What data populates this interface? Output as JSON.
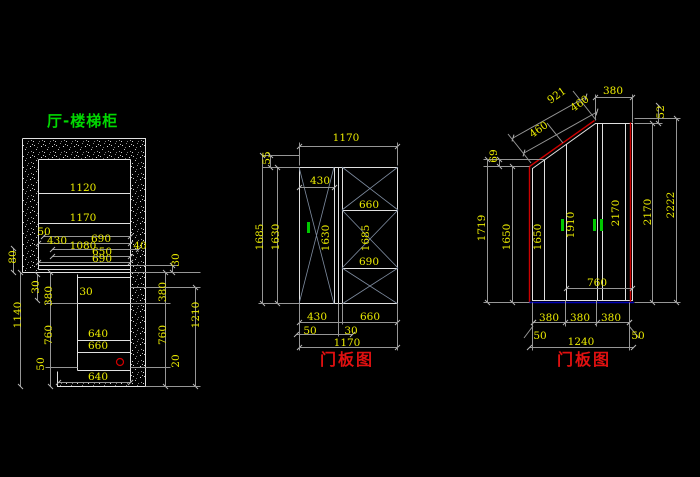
{
  "drawing_title": "厅-楼梯柜",
  "palette": {
    "background": "#000000",
    "outline_white": "#e0e0e0",
    "dim_line_gray": "#969696",
    "dim_text_yellow": "#ebeb00",
    "title_green": "#00d900",
    "caption_red": "#e01010",
    "edge_red": "#cc0000",
    "handle_green": "#00c800",
    "base_blue": "#0000b4",
    "swing_line_blue_gray": "#7e8ca0"
  },
  "views": {
    "section": {
      "title": "厅-楼梯柜",
      "labels": [
        {
          "text": "1120",
          "x": 83,
          "y": 188
        },
        {
          "text": "1170",
          "x": 83,
          "y": 218
        },
        {
          "text": "50",
          "x": 44,
          "y": 232
        },
        {
          "text": "430",
          "x": 57,
          "y": 241
        },
        {
          "text": "690",
          "x": 101,
          "y": 239
        },
        {
          "text": "1080",
          "x": 83,
          "y": 246
        },
        {
          "text": "40",
          "x": 140,
          "y": 246
        },
        {
          "text": "650",
          "x": 102,
          "y": 252
        },
        {
          "text": "690",
          "x": 102,
          "y": 259
        },
        {
          "text": "80",
          "x": 13,
          "y": 257,
          "rot": -90
        },
        {
          "text": "30",
          "x": 36,
          "y": 287,
          "rot": -90
        },
        {
          "text": "380",
          "x": 49,
          "y": 296,
          "rot": -90
        },
        {
          "text": "1140",
          "x": 18,
          "y": 315,
          "rot": -90
        },
        {
          "text": "760",
          "x": 49,
          "y": 335,
          "rot": -90
        },
        {
          "text": "50",
          "x": 41,
          "y": 364,
          "rot": -90
        },
        {
          "text": "30",
          "x": 86,
          "y": 292
        },
        {
          "text": "640",
          "x": 98,
          "y": 334
        },
        {
          "text": "660",
          "x": 98,
          "y": 346
        },
        {
          "text": "640",
          "x": 98,
          "y": 377
        },
        {
          "text": "30",
          "x": 176,
          "y": 260,
          "rot": -90
        },
        {
          "text": "380",
          "x": 163,
          "y": 292,
          "rot": -90
        },
        {
          "text": "760",
          "x": 163,
          "y": 335,
          "rot": -90
        },
        {
          "text": "20",
          "x": 176,
          "y": 361,
          "rot": -90
        },
        {
          "text": "1210",
          "x": 196,
          "y": 315,
          "rot": -90
        }
      ]
    },
    "door_panel_1": {
      "caption": "门板图",
      "labels": [
        {
          "text": "1170",
          "x": 346,
          "y": 138
        },
        {
          "text": "55",
          "x": 267,
          "y": 158,
          "rot": -90
        },
        {
          "text": "1685",
          "x": 260,
          "y": 237,
          "rot": -90
        },
        {
          "text": "1630",
          "x": 276,
          "y": 237,
          "rot": -90
        },
        {
          "text": "430",
          "x": 320,
          "y": 181
        },
        {
          "text": "1630",
          "x": 326,
          "y": 238,
          "rot": -90
        },
        {
          "text": "660",
          "x": 369,
          "y": 205
        },
        {
          "text": "1685",
          "x": 366,
          "y": 238,
          "rot": -90
        },
        {
          "text": "690",
          "x": 369,
          "y": 262
        },
        {
          "text": "430",
          "x": 317,
          "y": 317
        },
        {
          "text": "660",
          "x": 370,
          "y": 317
        },
        {
          "text": "50",
          "x": 310,
          "y": 331
        },
        {
          "text": "30",
          "x": 351,
          "y": 331
        },
        {
          "text": "1170",
          "x": 347,
          "y": 343
        }
      ]
    },
    "door_panel_2": {
      "caption": "门板图",
      "labels": [
        {
          "text": "921",
          "x": 557,
          "y": 96,
          "rot": -35
        },
        {
          "text": "460",
          "x": 539,
          "y": 130,
          "rot": -35
        },
        {
          "text": "460",
          "x": 580,
          "y": 104,
          "rot": -35
        },
        {
          "text": "380",
          "x": 613,
          "y": 91
        },
        {
          "text": "52",
          "x": 661,
          "y": 112,
          "rot": -90
        },
        {
          "text": "69",
          "x": 494,
          "y": 156,
          "rot": -90
        },
        {
          "text": "1719",
          "x": 482,
          "y": 228,
          "rot": -90
        },
        {
          "text": "1650",
          "x": 507,
          "y": 237,
          "rot": -90
        },
        {
          "text": "1650",
          "x": 538,
          "y": 237,
          "rot": -90
        },
        {
          "text": "1910",
          "x": 571,
          "y": 225,
          "rot": -90
        },
        {
          "text": "2170",
          "x": 616,
          "y": 213,
          "rot": -90
        },
        {
          "text": "2170",
          "x": 648,
          "y": 212,
          "rot": -90
        },
        {
          "text": "2222",
          "x": 671,
          "y": 205,
          "rot": -90
        },
        {
          "text": "760",
          "x": 597,
          "y": 283
        },
        {
          "text": "380",
          "x": 549,
          "y": 318
        },
        {
          "text": "380",
          "x": 580,
          "y": 318
        },
        {
          "text": "380",
          "x": 611,
          "y": 318
        },
        {
          "text": "50",
          "x": 540,
          "y": 336
        },
        {
          "text": "50",
          "x": 638,
          "y": 336
        },
        {
          "text": "1240",
          "x": 581,
          "y": 342
        }
      ]
    }
  }
}
